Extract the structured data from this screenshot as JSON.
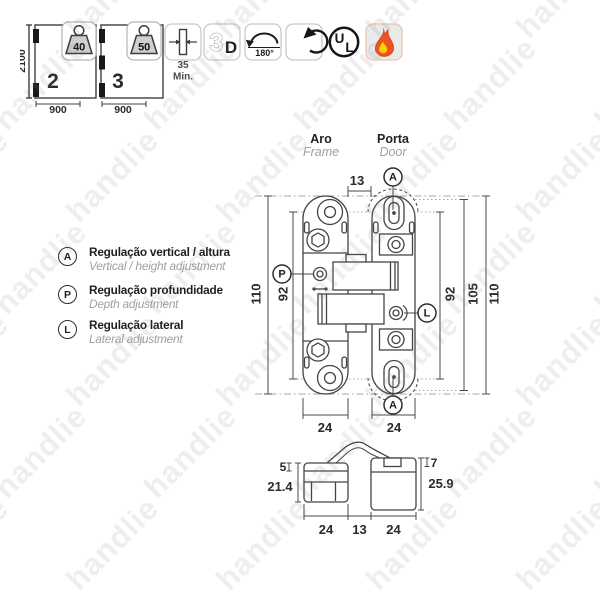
{
  "watermark": {
    "text": "handlie"
  },
  "top": {
    "door_two_hinges": {
      "height": "2100",
      "width": "900",
      "hinge_count": "2",
      "weight": "40"
    },
    "door_three_hinges": {
      "width": "900",
      "hinge_count": "3",
      "weight": "50"
    },
    "min_thickness": {
      "value": "35",
      "unit": "Min."
    },
    "three_d": {
      "three": "3",
      "d": "D"
    },
    "opening_angle": {
      "label": "180°"
    },
    "ul_mark": {
      "u": "U",
      "l": "L"
    }
  },
  "front_view": {
    "frame_pt": "Aro",
    "frame_en": "Frame",
    "door_pt": "Porta",
    "door_en": "Door",
    "gap": "13",
    "frame_outer_height": "110",
    "frame_hole_spacing": "92",
    "door_hole_spacing": "92",
    "door_body_height": "105",
    "door_outer_height": "110",
    "frame_width": "24",
    "door_width": "24",
    "marker_a_top": "A",
    "marker_a_bottom": "A",
    "marker_p": "P",
    "marker_l": "L"
  },
  "legend": {
    "items": [
      {
        "key": "A",
        "pt": "Regulação vertical / altura",
        "en": "Vertical / height adjustment"
      },
      {
        "key": "P",
        "pt": "Regulação profundidade",
        "en": "Depth adjustment"
      },
      {
        "key": "L",
        "pt": "Regulação lateral",
        "en": "Lateral adjustment"
      }
    ]
  },
  "section_view": {
    "frame_lip": "5",
    "frame_depth": "21.4",
    "door_lip": "7",
    "door_depth": "25.9",
    "frame_width": "24",
    "gap": "13",
    "door_width": "24"
  }
}
